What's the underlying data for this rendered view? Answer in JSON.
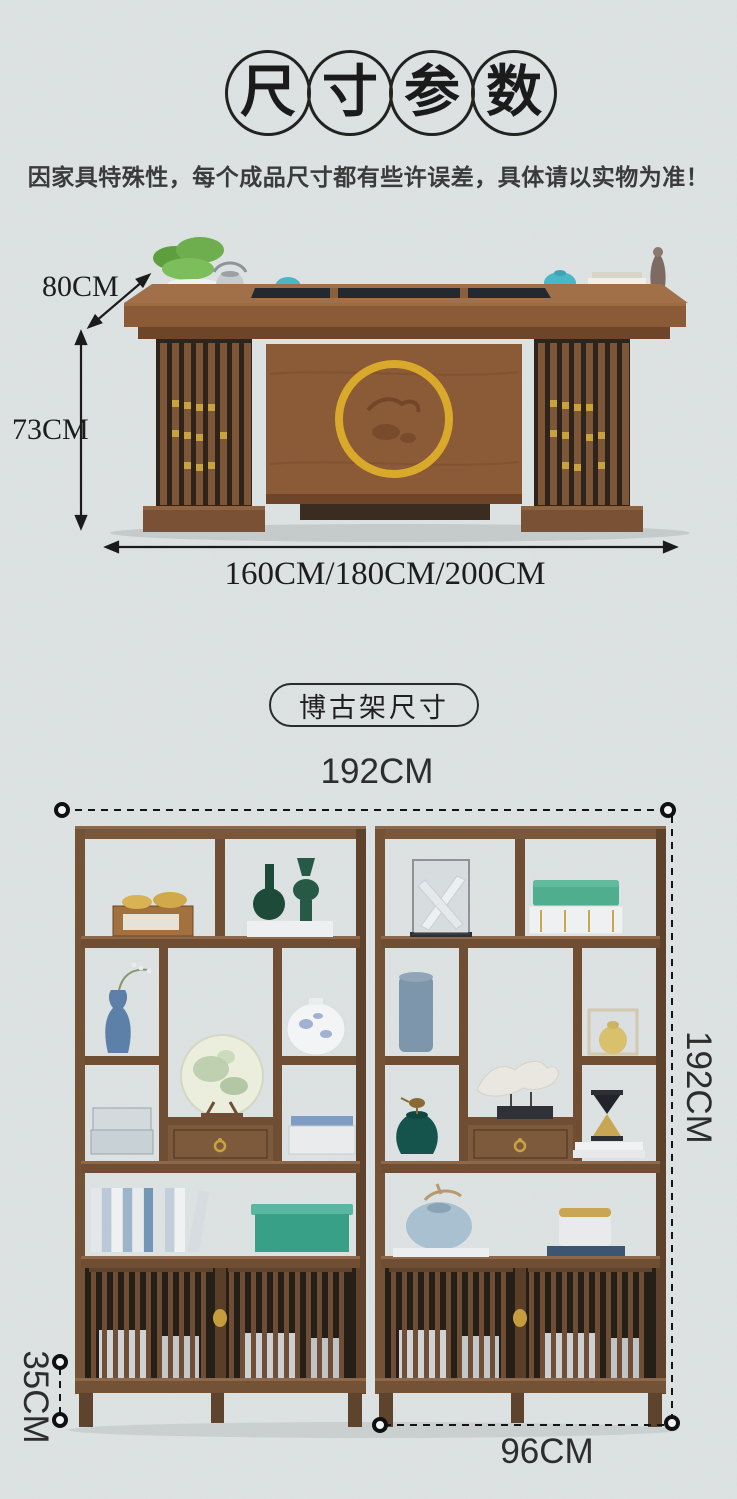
{
  "header": {
    "title_characters": [
      "尺",
      "寸",
      "参",
      "数"
    ],
    "notice": "因家具特殊性，每个成品尺寸都有些许误差，具体请以实物为准！"
  },
  "desk_diagram": {
    "depth_label": "80CM",
    "height_label": "73CM",
    "width_label": "160CM/180CM/200CM"
  },
  "shelf_diagram": {
    "badge": "博古架尺寸",
    "width_label": "192CM",
    "height_label": "192CM",
    "base_height_label": "35CM",
    "unit_width_label": "96CM"
  },
  "icons": {
    "dimension_arrow": "double-headed-arrow",
    "dimension_endpoint": "ring-dot",
    "dimension_line_style": "dashed"
  },
  "colors": {
    "background": "#dde2e3",
    "ink": "#1b1b1b",
    "notice_text": "#3b3b3b",
    "wood": "#7a573a",
    "wood_dark": "#55402c",
    "gold_ring": "#d9a92b",
    "teal_teaware": "#49b7c6",
    "plant_green": "#6fae4e"
  }
}
